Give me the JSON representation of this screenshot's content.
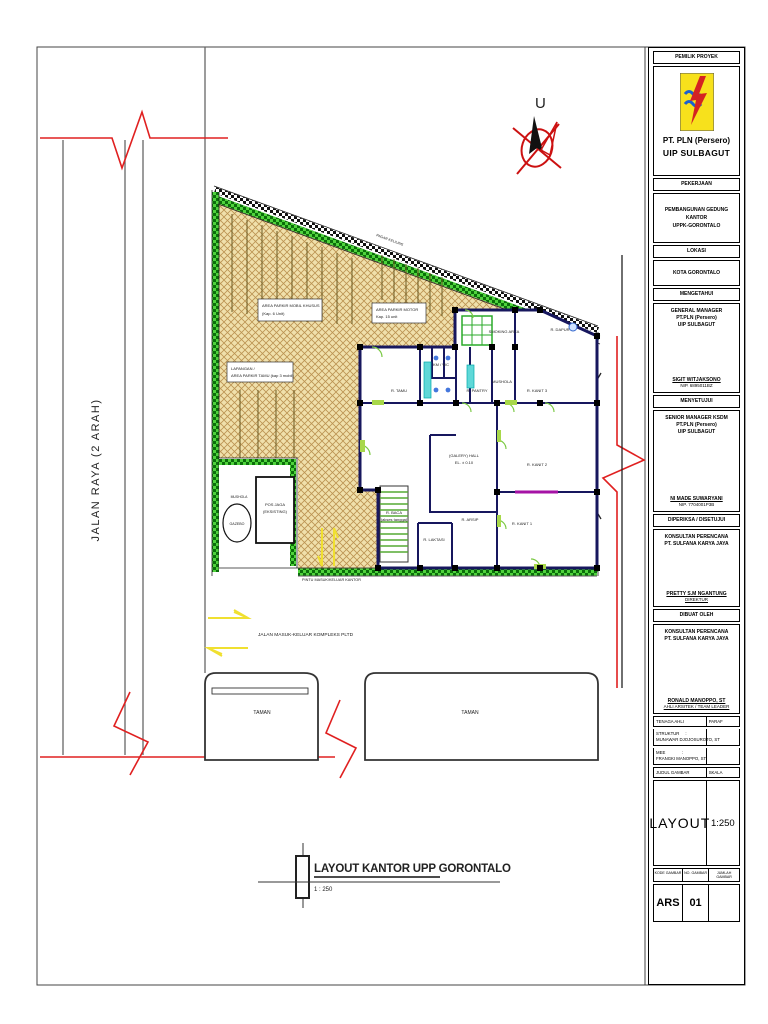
{
  "compass": {
    "label": "U"
  },
  "road_left": {
    "label": "JALAN RAYA (2 ARAH)"
  },
  "site": {
    "labels": {
      "parkir_mobil_1": "AREA PARKIR MOBIL KHUSUS",
      "parkir_mobil_2": "(Kap. 6 Unit)",
      "parkir_motor_1": "AREA PARKIR MOTOR",
      "parkir_motor_2": "Kap. 15 unit",
      "lapangan_1": "LAPANGAN /",
      "lapangan_2": "AREA PARKIR TAMU (kap 3 mobil)",
      "pagar_note": "PAGAR KELILING",
      "jalan_komplek": "JALAN KOMPLEKS PLTD",
      "mushola": "MUSHOLA",
      "gazebo": "GAZEBO",
      "pos_jaga_1": "POS JAGA",
      "pos_jaga_2": "(EKSISTING)",
      "pintu_masuk": "PINTU MASUK/KELUAR KANTOR"
    },
    "rooms": [
      {
        "label": "SMOKING AREA"
      },
      {
        "label": "R. DAPUR"
      },
      {
        "label": "R. TAMU"
      },
      {
        "label": "KM / WC"
      },
      {
        "label": "R. PANTRY"
      },
      {
        "label": "MUSHOLA"
      },
      {
        "label": "R. KANIT 3"
      },
      {
        "label": "(GALERY) HALL"
      },
      {
        "label": "EL. ± 0.10"
      },
      {
        "label": "R. KANIT 2"
      },
      {
        "label": "R. BACA"
      },
      {
        "label": "(akses tangga)"
      },
      {
        "label": "R. LAKTASI"
      },
      {
        "label": "R. ARSIP"
      },
      {
        "label": "R. KANIT 1"
      }
    ]
  },
  "grounds": {
    "jalan_masuk": "JALAN MASUK-KELUAR KOMPLEKS PLTD",
    "taman_left": "TAMAN",
    "taman_right": "TAMAN"
  },
  "footer": {
    "title": "LAYOUT KANTOR UPP GORONTALO",
    "scale": "1 : 250"
  },
  "title_block": {
    "s1_header": "PEMILIK PROYEK",
    "company1": "PT. PLN (Persero)",
    "company2": "UIP SULBAGUT",
    "s2_header": "PEKERJAAN",
    "job1": "PEMBANGUNAN GEDUNG KANTOR",
    "job2": "UPPK-GORONTALO",
    "s3_header": "LOKASI",
    "lokasi": "KOTA GORONTALO",
    "s4_header": "MENGETAHUI",
    "know1": "GENERAL MANAGER",
    "know2": "PT.PLN (Persero)",
    "know3": "UIP SULBAGUT",
    "know_name": "SIGIT WITJAKSONO",
    "know_nip": "NIP. 6895011BZ",
    "s5_header": "MENYETUJUI",
    "agree1": "SENIOR MANAGER KSDM",
    "agree2": "PT.PLN (Persero)",
    "agree3": "UIP SULBAGUT",
    "agree_name": "NI MADE SUWARYANI",
    "agree_nip": "NIP. 7704001P3B",
    "s6_header": "DIPERIKSA / DISETUJUI",
    "check1": "KONSULTAN PERENCANA",
    "check2": "PT. SULFANA KARYA JAYA",
    "check_name": "PRETTY S.M NGANTUNG",
    "check_role": "DIREKTUR",
    "s7_header": "DIBUAT OLEH",
    "made1": "KONSULTAN PERENCANA",
    "made2": "PT. SULFANA KARYA JAYA",
    "made_name": "RONALD MANOPPO, ST",
    "made_role": "AHLI ARSITEK / TEAM LEADER",
    "tenaga_ahli": "TENAGA AHLI",
    "paraf": "PARAF",
    "struktur_label": "STRUKTUR     :",
    "struktur_name": "MUNAWAR DJOJOSUROTO, ST",
    "mee_label": "MEE              :",
    "mee_name": "FRANGKI MANOPPO, ST",
    "judul_gambar": "JUDUL GAMBAR",
    "skala": "SKALA",
    "judul_value": "LAYOUT",
    "skala_value": "1:250",
    "kode_gambar": "KODE GAMBAR",
    "no_gambar": "NO. GAMBAR",
    "jumlah_gambar": "JUMLAH GAMBAR",
    "kode_value": "ARS",
    "no_value": "01",
    "jumlah_value": ""
  }
}
